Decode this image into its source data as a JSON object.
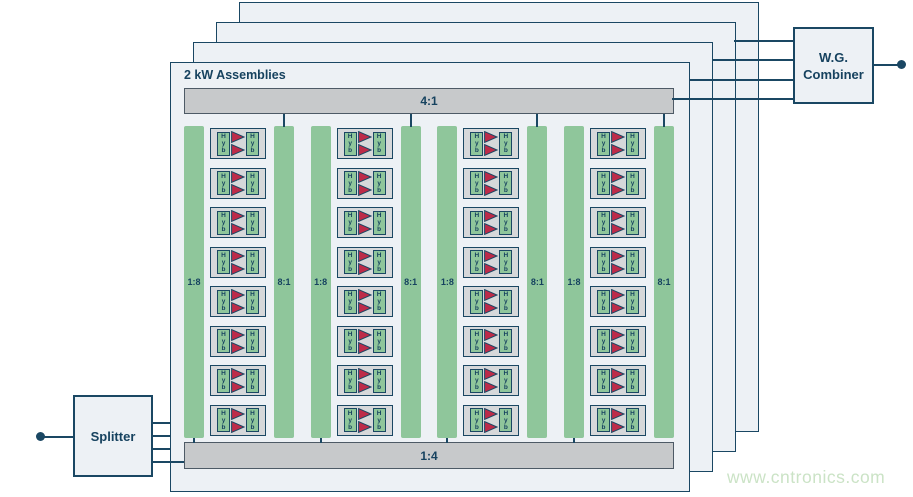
{
  "colors": {
    "navy": "#1a4763",
    "text_navy": "#16425f",
    "panel_fill": "#edf1f5",
    "bar_fill": "#c7c9cb",
    "bar_border": "#4d5a66",
    "module_fill": "#d6d8da",
    "green": "#8fc69b",
    "triangle_red": "#bd2b49",
    "watermark_green": "#cbe3c6",
    "background": "#ffffff"
  },
  "assembly": {
    "title": "2 kW Assemblies",
    "top_bar_label": "4:1",
    "bottom_bar_label": "1:4",
    "stacked_panel_count": 4,
    "columns": {
      "count": 4,
      "left_bar_label": "1:8",
      "right_bar_label": "8:1",
      "modules_per_column": 8,
      "module": {
        "hybrid_label_letters": [
          "H",
          "y",
          "b"
        ],
        "amplifiers_per_module": 2
      }
    }
  },
  "splitter": {
    "label": "Splitter"
  },
  "combiner": {
    "label_line1": "W.G.",
    "label_line2": "Combiner"
  },
  "watermark": {
    "text": "www.cntronics.com"
  }
}
